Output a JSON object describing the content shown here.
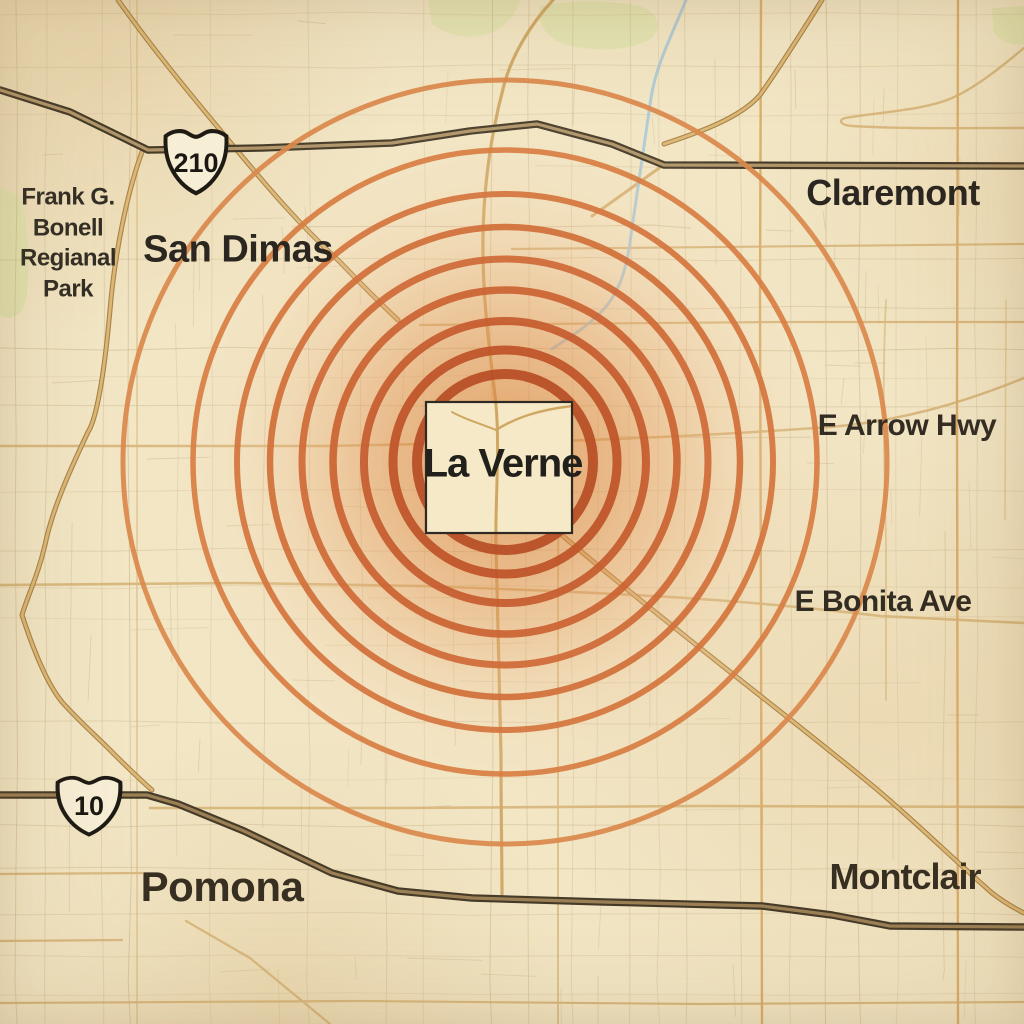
{
  "map": {
    "title": "La Verne area impact-rings map",
    "palette": {
      "background": "#f2e6c5",
      "ring_accent": "#c65c2f",
      "heat_center": "#d97b34",
      "freeway_casing": "#463b29",
      "freeway_core": "#ad9164",
      "arterial_tan": "#d6ae6c",
      "stream_blue": "#a7c7d6",
      "park_green": "#dfe3ae",
      "label_ink": "#2b2620"
    },
    "labels": {
      "park_lines": [
        "Frank G.",
        "Bonell",
        "Regianal",
        "Park"
      ],
      "san_dimas": "San Dimas",
      "claremont": "Claremont",
      "la_verne": "La Verne",
      "pomona": "Pomona",
      "montclair": "Montclair",
      "e_arrow_hwy": "E Arrow Hwy",
      "e_bonita_ave": "E Bonita Ave"
    },
    "shields": {
      "i210": "210",
      "i10": "10"
    },
    "rings": {
      "center": {
        "x": 505,
        "y": 462
      },
      "items": [
        {
          "r": 88,
          "width": 10,
          "color": "#b84d25"
        },
        {
          "r": 112,
          "width": 9,
          "color": "#bf5329"
        },
        {
          "r": 141,
          "width": 8,
          "color": "#c65c2f"
        },
        {
          "r": 172,
          "width": 7.5,
          "color": "#cb6333"
        },
        {
          "r": 203,
          "width": 7,
          "color": "#cf6a37"
        },
        {
          "r": 235,
          "width": 6.5,
          "color": "#d2703a"
        },
        {
          "r": 268,
          "width": 6,
          "color": "#d5763e"
        },
        {
          "r": 312,
          "width": 5.5,
          "color": "#d87e43"
        },
        {
          "r": 382,
          "width": 5,
          "color": "#db894c"
        }
      ]
    }
  }
}
